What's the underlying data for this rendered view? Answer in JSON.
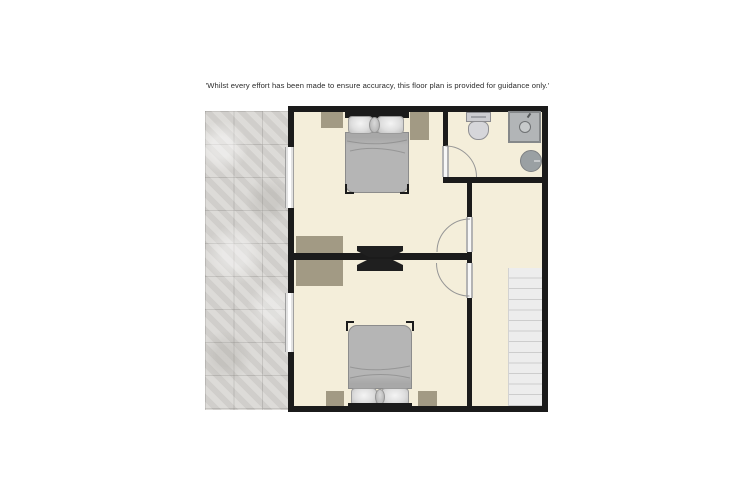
{
  "disclaimer": "'Whilst every effort has been made to ensure accuracy, this floor plan is provided for guidance only.'",
  "floorplan": {
    "description": "unlabelled upper-floor plan: two bedrooms, bathroom, landing with staircase, tiled roof area to the left",
    "colors": {
      "page": "#ffffff",
      "wall": "#1b1b1b",
      "floor": "#f4eeda",
      "tan": "#a29a84",
      "bed": "#b5b5b5",
      "bedline": "#8c8c8c",
      "texture": "#d7d5d2",
      "stairs": "#ededed",
      "stairline": "#cdcdcd",
      "fixture": "#b2b5b7",
      "fixline": "#85888a",
      "arc": "#969696",
      "tv": "#1f1f1f"
    },
    "rooms": [
      {
        "id": "bedroom-top",
        "position": "top-left",
        "furniture": [
          "double-bed",
          "pillows",
          "bedside-mat-left",
          "bedside-mat-right",
          "wall-tv",
          "shared-cabinet"
        ]
      },
      {
        "id": "bathroom",
        "position": "top-right",
        "fixtures": [
          "toilet",
          "vanity-unit",
          "round-washbasin"
        ]
      },
      {
        "id": "bedroom-bottom",
        "position": "bottom-left",
        "furniture": [
          "double-bed",
          "pillows",
          "bedside-mat-left",
          "bedside-mat-right",
          "wall-tv",
          "shared-cabinet"
        ]
      },
      {
        "id": "landing",
        "position": "right",
        "features": [
          "staircase"
        ]
      }
    ],
    "counts": {
      "windows": 2,
      "doors": 3,
      "stair_treads": 13
    },
    "exterior_left": "tiled-roof-texture"
  }
}
